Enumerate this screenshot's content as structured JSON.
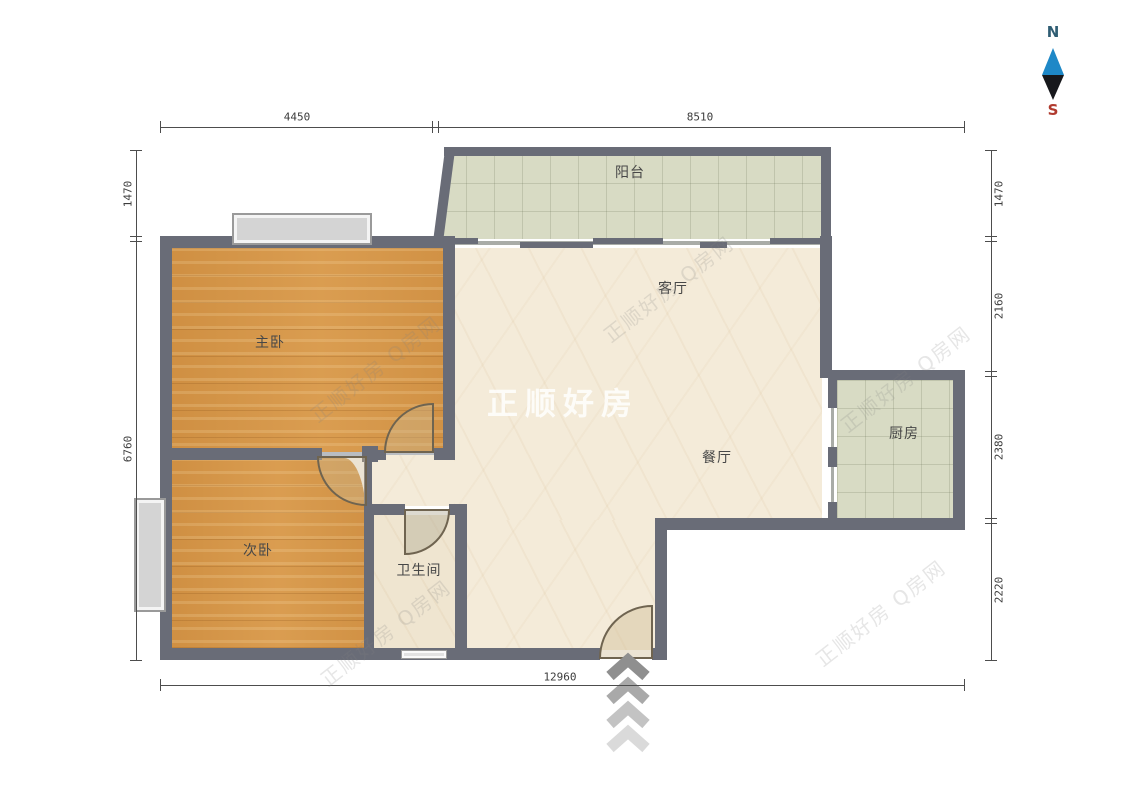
{
  "title": "apartment-floor-plan",
  "compass": {
    "north": "N",
    "south": "S"
  },
  "rooms": {
    "balcony": "阳台",
    "living": "客厅",
    "master_bedroom": "主卧",
    "dining": "餐厅",
    "kitchen": "厨房",
    "second_bedroom": "次卧",
    "bathroom": "卫生间"
  },
  "dimensions": {
    "top": [
      "4450",
      "8510"
    ],
    "left": [
      "1470",
      "6760"
    ],
    "right": [
      "1470",
      "2160",
      "2380",
      "2220"
    ],
    "bottom": [
      "12960"
    ]
  },
  "watermark": {
    "center": "正顺好房",
    "diagonal": "正顺好房 Q房网"
  },
  "colors": {
    "wall": "#696c77",
    "wood_floor": "#d5974b",
    "tile_floor": "#d8dbc4",
    "marble_floor": "#f4ebd9",
    "compass_north": "#2f5d73",
    "compass_south": "#b03a2e",
    "compass_arrow_top": "#1e88c7",
    "compass_arrow_bottom": "#17181c"
  }
}
